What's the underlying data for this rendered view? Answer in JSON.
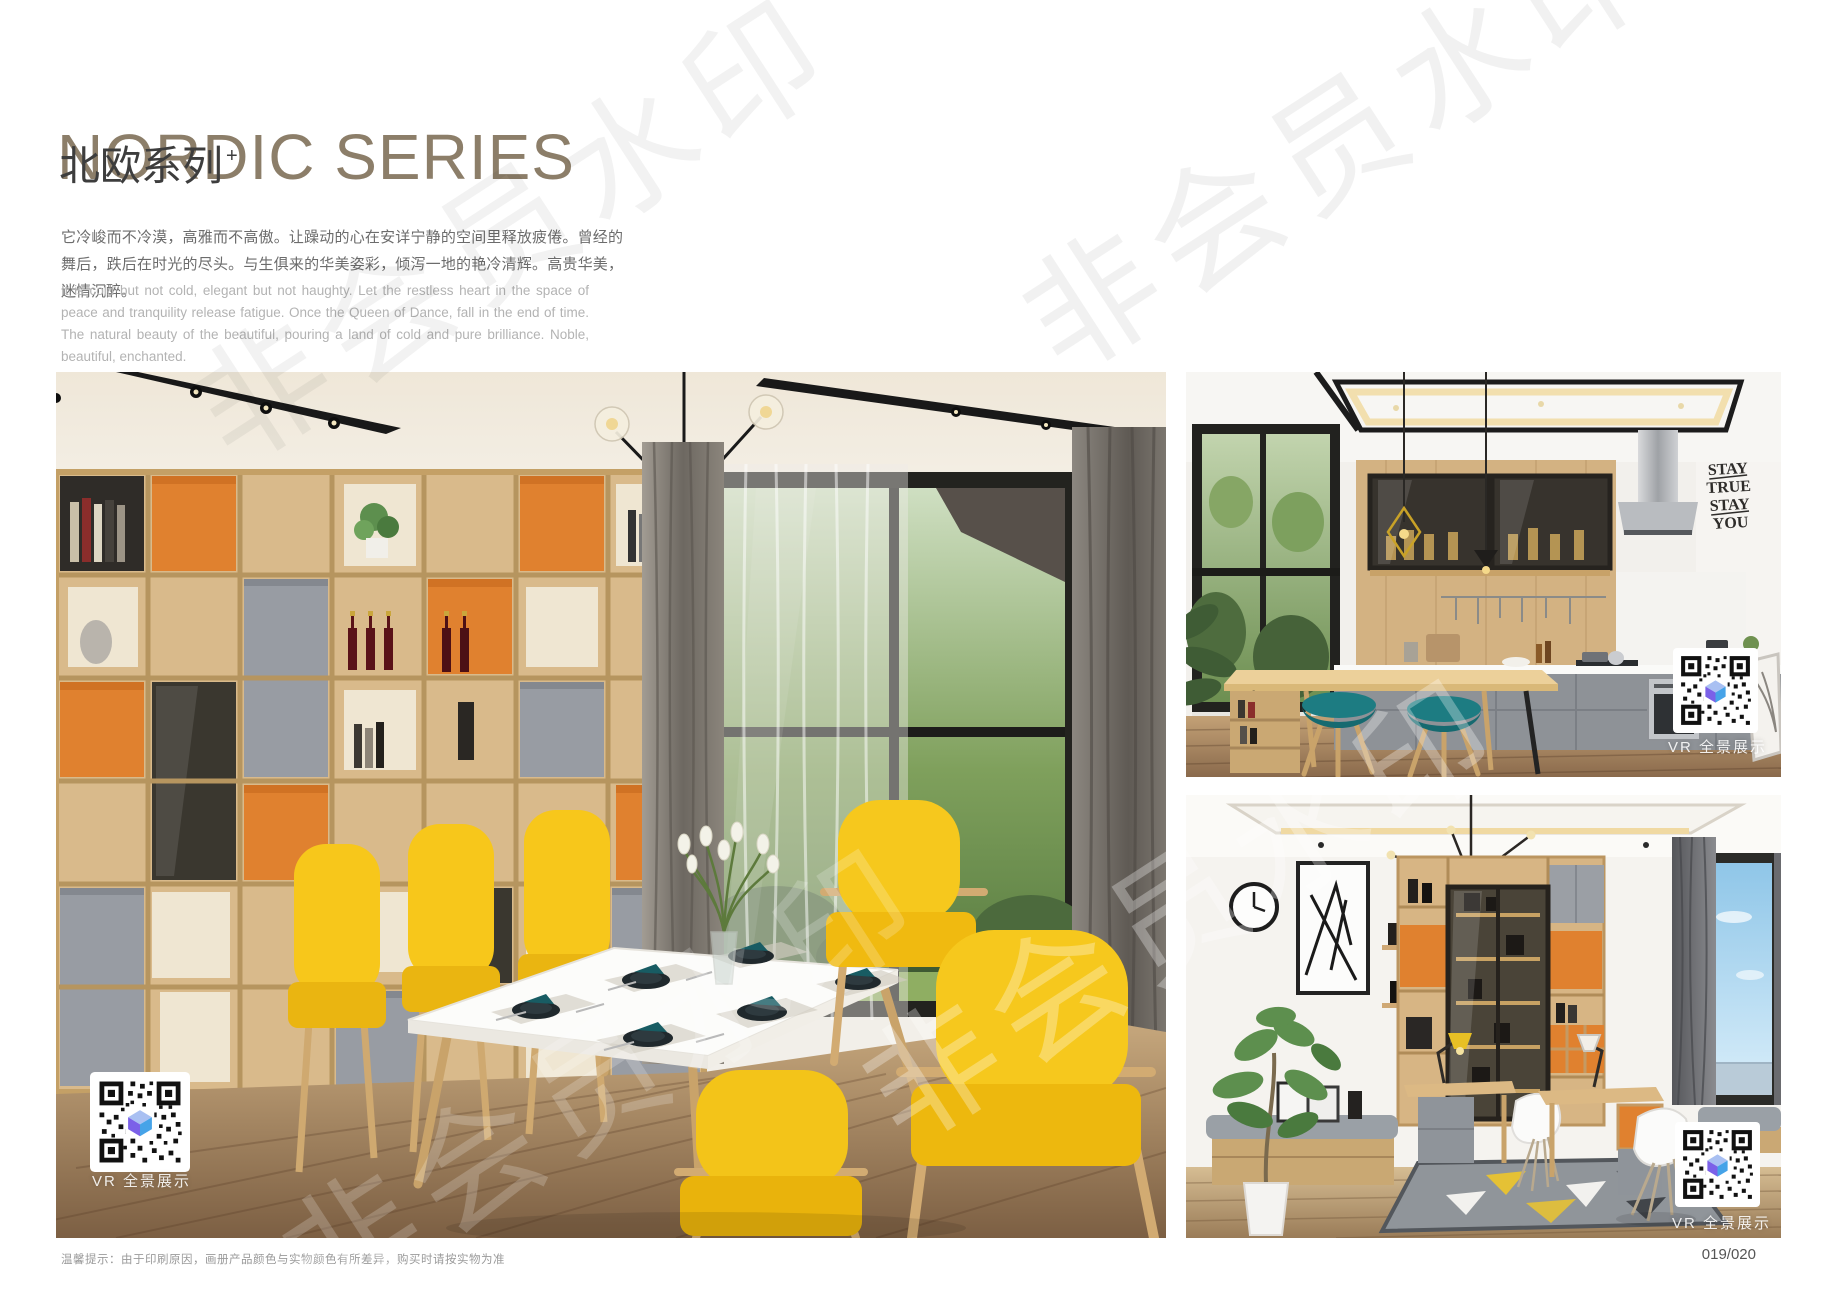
{
  "header": {
    "title": "NORDIC SERIES",
    "subtitle_cn": "北欧系列",
    "subtitle_sup": "+",
    "desc_cn": "它冷峻而不冷漠，高雅而不高傲。让躁动的心在安详宁静的空间里释放疲倦。曾经的舞后，跌后在时光的尽头。与生俱来的华美姿彩，倾泻一地的艳冷清辉。高贵华美，迷情沉醉。",
    "desc_en": "It is cold but not cold, elegant but not haughty. Let the restless heart in the space of peace and tranquility release fatigue. Once the Queen of Dance, fall in the end of time. The natural beauty of the beautiful, pouring a land of cold and pure brilliance. Noble, beautiful, enchanted."
  },
  "watermark": {
    "text": "非会员水印"
  },
  "photos": {
    "dining": {
      "vr_label": "VR 全景展示"
    },
    "kitchen": {
      "vr_label": "VR 全景展示",
      "wall_text_lines": [
        "STAY",
        "TRUE",
        "STAY",
        "YOU"
      ]
    },
    "study": {
      "vr_label": "VR 全景展示"
    }
  },
  "footer": {
    "note": "温馨提示：由于印刷原因，画册产品颜色与实物颜色有所差异，购买时请按实物为准",
    "page_number": "019/020"
  },
  "colors": {
    "title_brown": "#8c7e69",
    "accent_orange": "#e0812f",
    "chair_yellow": "#f6c81d",
    "stool_teal": "#1d7c82",
    "napkin_teal": "#185c63",
    "cabinet_gray": "#94989e",
    "wood_light": "#d8b886",
    "qr_cube_purple": "#7b61e8",
    "qr_cube_blue": "#46a3e8"
  }
}
